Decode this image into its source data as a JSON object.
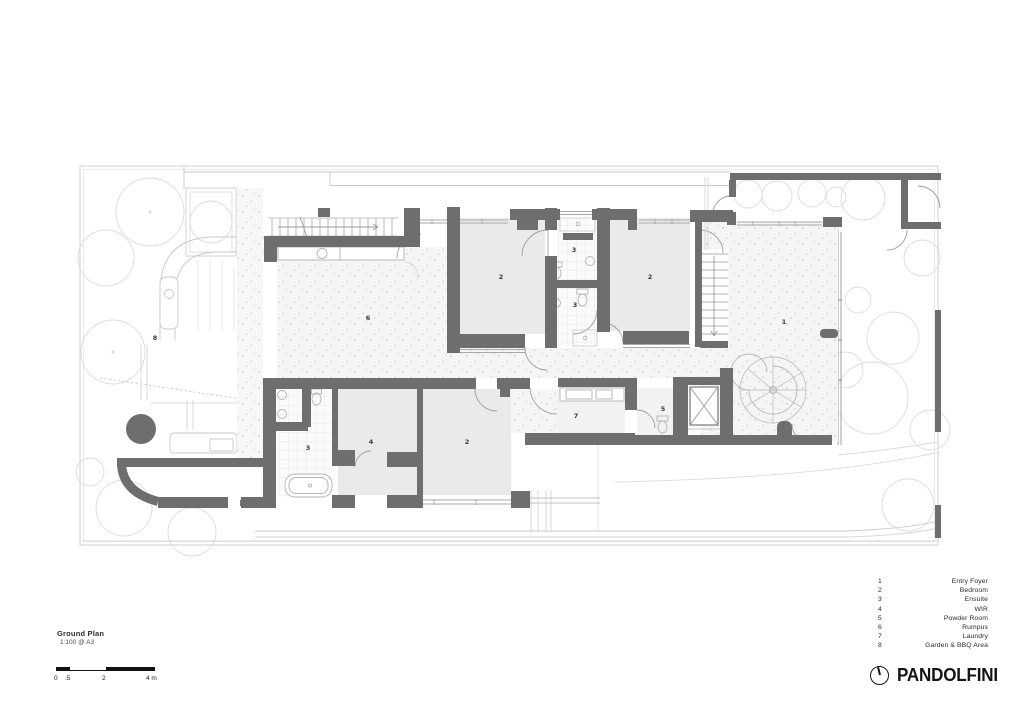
{
  "drawing": {
    "title": "Ground Plan",
    "scale_note": "1:100 @ A3",
    "type": "architectural floor plan"
  },
  "scale_bar": {
    "labels": [
      {
        "text": "0",
        "x": 0
      },
      {
        "text": ".5",
        "x": 11
      },
      {
        "text": "2",
        "x": 48
      },
      {
        "text": "4 m",
        "x": 92
      }
    ]
  },
  "legend": {
    "items": [
      {
        "num": "1",
        "label": "Entry Foyer"
      },
      {
        "num": "2",
        "label": "Bedroom"
      },
      {
        "num": "3",
        "label": "Ensuite"
      },
      {
        "num": "4",
        "label": "WIR"
      },
      {
        "num": "5",
        "label": "Powder Room"
      },
      {
        "num": "6",
        "label": "Rumpus"
      },
      {
        "num": "7",
        "label": "Laundry"
      },
      {
        "num": "8",
        "label": "Garden & BBQ Area"
      }
    ]
  },
  "plan": {
    "room_labels": [
      {
        "text": "1",
        "x": 784,
        "y": 324
      },
      {
        "text": "2",
        "x": 501,
        "y": 279
      },
      {
        "text": "2",
        "x": 650,
        "y": 279
      },
      {
        "text": "2",
        "x": 467,
        "y": 444
      },
      {
        "text": "3",
        "x": 574,
        "y": 252
      },
      {
        "text": "3",
        "x": 575,
        "y": 307
      },
      {
        "text": "3",
        "x": 308,
        "y": 450
      },
      {
        "text": "4",
        "x": 371,
        "y": 444
      },
      {
        "text": "5",
        "x": 663,
        "y": 411
      },
      {
        "text": "6",
        "x": 368,
        "y": 320
      },
      {
        "text": "7",
        "x": 576,
        "y": 418
      },
      {
        "text": "8",
        "x": 155,
        "y": 340
      }
    ]
  },
  "brand": {
    "name": "PANDOLFINI",
    "logo_icon": "dial-circle-icon"
  },
  "colors": {
    "wall": "#6e6e6e",
    "room_fill": "#eaeaea",
    "speckle_bg": "#f5f5f4",
    "thin_line": "#b3b3b1",
    "faint_line": "#dcdcda",
    "ink": "#141414"
  }
}
